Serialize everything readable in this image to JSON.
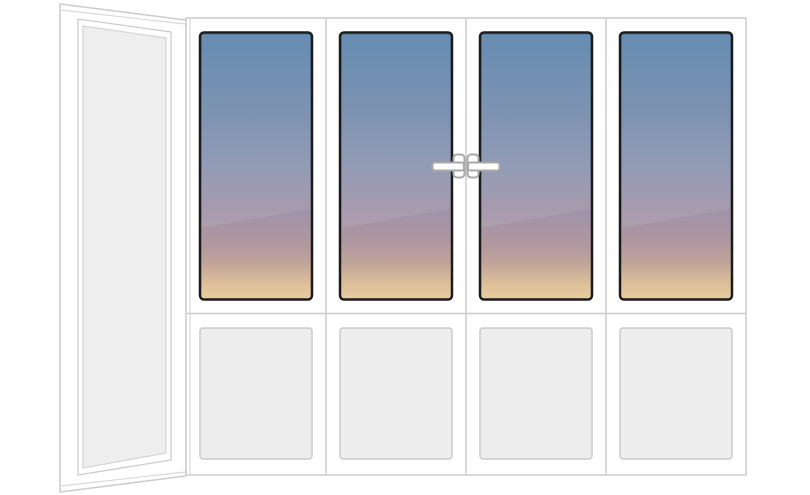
{
  "diagram": {
    "title": "Corner balcony glazing layout: one side fixed opaque panel and four front sections with sunset glass tops, opaque bottom panels, two operable middle sashes with handles",
    "colors": {
      "background": "#ffffff",
      "frame_fill": "#ffffff",
      "frame_stroke": "#cccccc",
      "frame_stroke_soft": "#d9d9d9",
      "side_panel_fill": "#eeeeee",
      "side_panel_stroke": "#d6d6d6",
      "bottom_panel_fill": "#ededed",
      "bottom_panel_stroke": "#cccccc",
      "glass_border": "#1b1b1b",
      "glass_sheen": "rgba(255,255,255,0.09)",
      "handle_fill": "#ffffff",
      "handle_stroke": "#a8a8a8",
      "glass_gradient": {
        "stop0": "#5681aa",
        "stop1": "#7189ab",
        "stop2": "#8892ae",
        "stop3": "#9e92a8",
        "stop4": "#ae97a0",
        "stop5": "#bfa399",
        "stop6": "#dcbf99",
        "stop7": "#e8cda3"
      }
    },
    "structure": {
      "side_panel": {
        "position": "left",
        "view": "perspective",
        "type": "fixed",
        "infill": "opaque-panel"
      },
      "sections": [
        {
          "id": 1,
          "top": "sunset-glass",
          "bottom": "opaque-panel",
          "opening": "fixed",
          "handle": "none"
        },
        {
          "id": 2,
          "top": "sunset-glass",
          "bottom": "opaque-panel",
          "opening": "operable",
          "handle": "right-edge"
        },
        {
          "id": 3,
          "top": "sunset-glass",
          "bottom": "opaque-panel",
          "opening": "operable",
          "handle": "left-edge"
        },
        {
          "id": 4,
          "top": "sunset-glass",
          "bottom": "opaque-panel",
          "opening": "fixed",
          "handle": "none"
        }
      ]
    }
  }
}
